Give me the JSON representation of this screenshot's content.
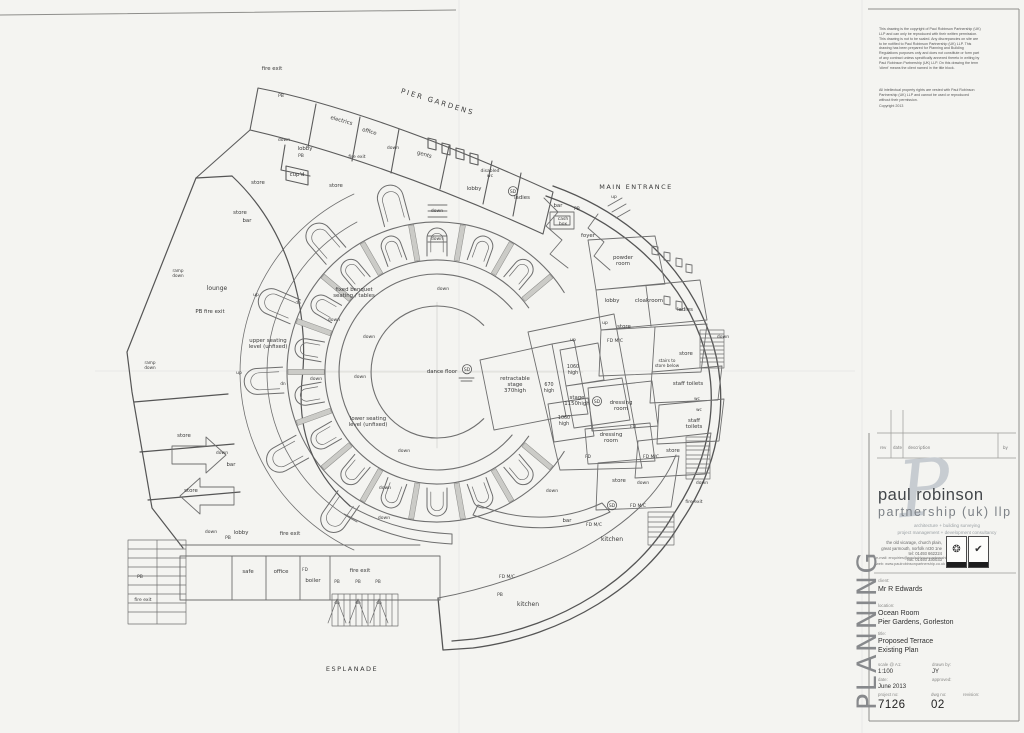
{
  "sheet": {
    "planning_watermark": "PLANNING"
  },
  "disclaimer": {
    "para1": "This drawing is the copyright of Paul Robinson Partnership (UK) LLP and can only be reproduced with their written permission.\nThis drawing is not to be scaled. Any discrepancies on site are to be notified to Paul Robinson Partnership (UK) LLP. This drawing has been prepared for Planning and Building Regulations purposes only and does not constitute or form part of any contract unless specifically annexed thereto in writing by Paul Robinson Partnership (UK) LLP. On this drawing the term 'client' means the client named in the title block.",
    "para2": "All intellectual property rights are vested with Paul Robinson Partnership (UK) LLP and cannot be used or reproduced without their permission.",
    "copyright": "Copyright 2013"
  },
  "revision_table": {
    "headers": {
      "rev": "rev",
      "date": "date",
      "description": "description",
      "by": "by"
    }
  },
  "firm": {
    "logo_letter": "P",
    "name_line1": "paul robinson",
    "name_line2": "partnership (uk) llp",
    "tagline1": "architecture + building surveying",
    "tagline2": "project management + development consultancy",
    "address": "the old vicarage, church plain,\ngreat yarmouth, norfolk nr30 1ne\ntel: 01493 662224\nfax: 01493 330033",
    "email_web": "e-mail: enquiries@paulrobinsonpartnership.co.uk\nweb:  www.paulrobinsonpartnership.co.uk",
    "badges": [
      {
        "icon": "seal-icon",
        "glyph": "❂"
      },
      {
        "icon": "check-icon",
        "glyph": "✔"
      }
    ]
  },
  "title_block": {
    "client_label": "client:",
    "client": "Mr R Edwards",
    "location_label": "location:",
    "location_line1": "Ocean Room",
    "location_line2": "Pier Gardens, Gorleston",
    "title_label": "title:",
    "title_line1": "Proposed Terrace",
    "title_line2": "Existing Plan",
    "scale_label": "scale @ A1:",
    "scale": "1:100",
    "drawn_label": "drawn by:",
    "drawn": "JY",
    "date_label": "date:",
    "date": "June 2013",
    "approved_label": "approved:",
    "approved": "",
    "project_label": "project no:",
    "project_no": "7126",
    "dwg_label": "dwg no:",
    "dwg_no": "02",
    "revision_label": "revision:",
    "revision": ""
  },
  "plan": {
    "labels": [
      {
        "t": "fire exit",
        "x": 272,
        "y": 70
      },
      {
        "t": "PB",
        "x": 281,
        "y": 97,
        "s": 4.5
      },
      {
        "t": "PIER GARDENS",
        "x": 437,
        "y": 104,
        "s": 7,
        "r": 17,
        "sp": 2,
        "n": "site-label-pier-gardens"
      },
      {
        "t": "electrics",
        "x": 341,
        "y": 122,
        "r": 16
      },
      {
        "t": "office",
        "x": 369,
        "y": 133,
        "r": 16
      },
      {
        "t": "down",
        "x": 284,
        "y": 141,
        "s": 4.5
      },
      {
        "t": "lobby",
        "x": 305,
        "y": 150
      },
      {
        "t": "PB",
        "x": 301,
        "y": 157,
        "s": 4.5
      },
      {
        "t": "cup'd",
        "x": 297,
        "y": 176
      },
      {
        "t": "fire exit",
        "x": 357,
        "y": 158,
        "s": 4.5
      },
      {
        "t": "store",
        "x": 258,
        "y": 184
      },
      {
        "t": "store",
        "x": 240,
        "y": 214
      },
      {
        "t": "bar",
        "x": 247,
        "y": 222
      },
      {
        "t": "store",
        "x": 336,
        "y": 187
      },
      {
        "t": "down",
        "x": 393,
        "y": 149,
        "s": 4.5
      },
      {
        "t": "gents",
        "x": 424,
        "y": 156,
        "r": 16
      },
      {
        "t": "disabled",
        "x": 490,
        "y": 172,
        "s": 4.5
      },
      {
        "t": "wc",
        "x": 490,
        "y": 177,
        "s": 4.5
      },
      {
        "t": "lobby",
        "x": 474,
        "y": 190
      },
      {
        "t": "SD",
        "x": 513,
        "y": 193,
        "s": 4.5,
        "c": 1,
        "n": "sd-marker"
      },
      {
        "t": "ladies",
        "x": 522,
        "y": 199
      },
      {
        "t": "bar",
        "x": 558,
        "y": 207
      },
      {
        "t": "PB",
        "x": 577,
        "y": 210,
        "s": 4.5
      },
      {
        "t": "cash",
        "x": 563,
        "y": 220,
        "s": 4.5
      },
      {
        "t": "box",
        "x": 563,
        "y": 225,
        "s": 4.5
      },
      {
        "t": "foyer",
        "x": 588,
        "y": 237
      },
      {
        "t": "MAIN ENTRANCE",
        "x": 636,
        "y": 189,
        "s": 6.5,
        "sp": 1.5,
        "n": "site-label-main-entrance"
      },
      {
        "t": "up",
        "x": 614,
        "y": 198,
        "s": 4.5
      },
      {
        "t": "powder",
        "x": 623,
        "y": 259
      },
      {
        "t": "room",
        "x": 623,
        "y": 265
      },
      {
        "t": "lobby",
        "x": 612,
        "y": 302
      },
      {
        "t": "cloakroom",
        "x": 649,
        "y": 302
      },
      {
        "t": "ladies",
        "x": 685,
        "y": 311
      },
      {
        "t": "up",
        "x": 605,
        "y": 324,
        "s": 4.5
      },
      {
        "t": "store",
        "x": 624,
        "y": 328
      },
      {
        "t": "FD M/C",
        "x": 615,
        "y": 342,
        "s": 4.5
      },
      {
        "t": "up",
        "x": 573,
        "y": 341,
        "s": 4.5
      },
      {
        "t": "down",
        "x": 723,
        "y": 338,
        "s": 4.5
      },
      {
        "t": "store",
        "x": 686,
        "y": 355
      },
      {
        "t": "stairs to",
        "x": 667,
        "y": 362,
        "s": 4.2
      },
      {
        "t": "store below",
        "x": 667,
        "y": 367,
        "s": 4.2
      },
      {
        "t": "staff toilets",
        "x": 688,
        "y": 385
      },
      {
        "t": "1060",
        "x": 573,
        "y": 368,
        "s": 4.8
      },
      {
        "t": "high",
        "x": 573,
        "y": 374,
        "s": 4.8
      },
      {
        "t": "670",
        "x": 549,
        "y": 386,
        "s": 4.8
      },
      {
        "t": "high",
        "x": 549,
        "y": 392,
        "s": 4.8
      },
      {
        "t": "retractable",
        "x": 515,
        "y": 380
      },
      {
        "t": "stage",
        "x": 515,
        "y": 386
      },
      {
        "t": "370high",
        "x": 515,
        "y": 392
      },
      {
        "t": "dance floor",
        "x": 442,
        "y": 373
      },
      {
        "t": "SD",
        "x": 467,
        "y": 371,
        "s": 4.5,
        "c": 1,
        "n": "sd-marker"
      },
      {
        "t": "stage",
        "x": 577,
        "y": 399
      },
      {
        "t": "1150high",
        "x": 577,
        "y": 405
      },
      {
        "t": "SD",
        "x": 597,
        "y": 403,
        "s": 4.5,
        "c": 1,
        "n": "sd-marker"
      },
      {
        "t": "1060",
        "x": 564,
        "y": 419,
        "s": 4.8
      },
      {
        "t": "high",
        "x": 564,
        "y": 425,
        "s": 4.8
      },
      {
        "t": "dressing",
        "x": 621,
        "y": 404
      },
      {
        "t": "room",
        "x": 621,
        "y": 410
      },
      {
        "t": "wc",
        "x": 697,
        "y": 400,
        "s": 4.2
      },
      {
        "t": "wc",
        "x": 699,
        "y": 411,
        "s": 4.2
      },
      {
        "t": "staff",
        "x": 694,
        "y": 422
      },
      {
        "t": "toilets",
        "x": 694,
        "y": 428
      },
      {
        "t": "dressing",
        "x": 611,
        "y": 436
      },
      {
        "t": "room",
        "x": 611,
        "y": 442
      },
      {
        "t": "FD",
        "x": 633,
        "y": 428,
        "s": 4.2
      },
      {
        "t": "FD",
        "x": 588,
        "y": 458,
        "s": 4.2
      },
      {
        "t": "store",
        "x": 673,
        "y": 452
      },
      {
        "t": "FD M/C",
        "x": 651,
        "y": 458,
        "s": 4.5
      },
      {
        "t": "store",
        "x": 619,
        "y": 482
      },
      {
        "t": "down",
        "x": 643,
        "y": 484,
        "s": 4.5
      },
      {
        "t": "down",
        "x": 702,
        "y": 484,
        "s": 4.5
      },
      {
        "t": "fire exit",
        "x": 694,
        "y": 503,
        "s": 4.5
      },
      {
        "t": "FD M/C",
        "x": 638,
        "y": 507,
        "s": 4.5
      },
      {
        "t": "SD",
        "x": 612,
        "y": 507,
        "s": 4.5,
        "c": 1,
        "n": "sd-marker"
      },
      {
        "t": "down",
        "x": 552,
        "y": 492,
        "s": 4.5
      },
      {
        "t": "bar",
        "x": 567,
        "y": 522
      },
      {
        "t": "FD M/C",
        "x": 594,
        "y": 526,
        "s": 4.5
      },
      {
        "t": "kitchen",
        "x": 612,
        "y": 541,
        "s": 6
      },
      {
        "t": "FD M/C",
        "x": 507,
        "y": 578,
        "s": 4.5
      },
      {
        "t": "PB",
        "x": 500,
        "y": 596,
        "s": 4.5
      },
      {
        "t": "kitchen",
        "x": 528,
        "y": 606,
        "s": 6
      },
      {
        "t": "ramp",
        "x": 178,
        "y": 272,
        "s": 4.2
      },
      {
        "t": "down",
        "x": 178,
        "y": 277,
        "s": 4.2
      },
      {
        "t": "lounge",
        "x": 217,
        "y": 290,
        "s": 6
      },
      {
        "t": "up",
        "x": 256,
        "y": 296,
        "s": 4.5
      },
      {
        "t": "PB fire exit",
        "x": 210,
        "y": 313
      },
      {
        "t": "upper seating",
        "x": 268,
        "y": 342
      },
      {
        "t": "level (unfixed)",
        "x": 268,
        "y": 348
      },
      {
        "t": "ramp",
        "x": 150,
        "y": 364,
        "s": 4.2
      },
      {
        "t": "down",
        "x": 150,
        "y": 369,
        "s": 4.2
      },
      {
        "t": "up",
        "x": 239,
        "y": 374,
        "s": 4.5
      },
      {
        "t": "dn",
        "x": 298,
        "y": 304,
        "s": 4.2
      },
      {
        "t": "down",
        "x": 316,
        "y": 380,
        "s": 4.5
      },
      {
        "t": "dn",
        "x": 283,
        "y": 385,
        "s": 4.2
      },
      {
        "t": "fixed banquet",
        "x": 354,
        "y": 291
      },
      {
        "t": "seating / tables",
        "x": 354,
        "y": 297
      },
      {
        "t": "down",
        "x": 443,
        "y": 290,
        "s": 4.5
      },
      {
        "t": "down",
        "x": 334,
        "y": 321,
        "s": 4.5
      },
      {
        "t": "down",
        "x": 369,
        "y": 338,
        "s": 4.5
      },
      {
        "t": "down",
        "x": 360,
        "y": 378,
        "s": 4.5
      },
      {
        "t": "lower seating",
        "x": 368,
        "y": 420
      },
      {
        "t": "level (unfixed)",
        "x": 368,
        "y": 426
      },
      {
        "t": "down",
        "x": 404,
        "y": 452,
        "s": 4.5
      },
      {
        "t": "down",
        "x": 385,
        "y": 489,
        "s": 4.5
      },
      {
        "t": "down",
        "x": 384,
        "y": 519,
        "s": 4.5
      },
      {
        "t": "down",
        "x": 437,
        "y": 212,
        "s": 4.5
      },
      {
        "t": "down",
        "x": 437,
        "y": 240,
        "s": 4.5
      },
      {
        "t": "store",
        "x": 184,
        "y": 437
      },
      {
        "t": "down",
        "x": 222,
        "y": 454,
        "s": 4.5
      },
      {
        "t": "bar",
        "x": 231,
        "y": 466
      },
      {
        "t": "store",
        "x": 191,
        "y": 492
      },
      {
        "t": "down",
        "x": 211,
        "y": 533,
        "s": 4.5
      },
      {
        "t": "lobby",
        "x": 241,
        "y": 534
      },
      {
        "t": "PB",
        "x": 228,
        "y": 539,
        "s": 4.5
      },
      {
        "t": "fire exit",
        "x": 290,
        "y": 535
      },
      {
        "t": "safe",
        "x": 248,
        "y": 573
      },
      {
        "t": "office",
        "x": 281,
        "y": 573
      },
      {
        "t": "FD",
        "x": 305,
        "y": 571,
        "s": 4.2
      },
      {
        "t": "boiler",
        "x": 313,
        "y": 582
      },
      {
        "t": "fire exit",
        "x": 360,
        "y": 572
      },
      {
        "t": "PB",
        "x": 337,
        "y": 583,
        "s": 4.2
      },
      {
        "t": "PB",
        "x": 358,
        "y": 583,
        "s": 4.2
      },
      {
        "t": "PB",
        "x": 378,
        "y": 583,
        "s": 4.2
      },
      {
        "t": "dn",
        "x": 337,
        "y": 604,
        "s": 4.2
      },
      {
        "t": "dn",
        "x": 358,
        "y": 604,
        "s": 4.2
      },
      {
        "t": "dn",
        "x": 379,
        "y": 604,
        "s": 4.2
      },
      {
        "t": "PB",
        "x": 140,
        "y": 578,
        "s": 4.5
      },
      {
        "t": "fire exit",
        "x": 143,
        "y": 601,
        "s": 4.5
      },
      {
        "t": "ESPLANADE",
        "x": 352,
        "y": 671,
        "s": 6.5,
        "sp": 1.5,
        "n": "site-label-esplanade"
      }
    ]
  }
}
